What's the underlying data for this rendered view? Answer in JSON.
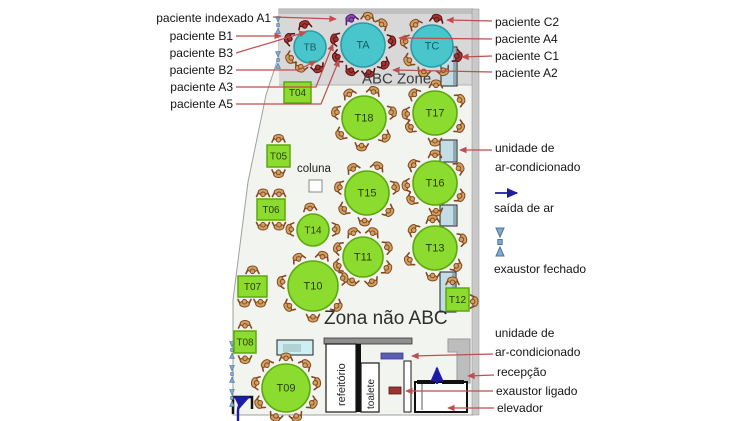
{
  "zones": {
    "abc": "ABC Zone",
    "non_abc": "Zona não ABC",
    "column": "coluna"
  },
  "rooms": {
    "cafeteria": "refeitório",
    "toilet": "toalete"
  },
  "colors": {
    "floor": "#f2f4ef",
    "zone": "#d8d8d8",
    "zone_top": "#bfbfbf",
    "wall": "#c9c9c9",
    "table_green": "#8bdc2f",
    "table_green_border": "#5ea80f",
    "table_cyan": "#49c6cc",
    "table_cyan_border": "#2e9aa4",
    "arrow_red": "#bf4e4e",
    "arrow_blue": "#1c1ca8",
    "exhaust_blue": "#82aacd",
    "exhaust_border": "#49739a",
    "person_tan": "#cda263",
    "person_tan_stroke": "#87471f",
    "person_red": "#a23432",
    "person_red_stroke": "#5c1414",
    "person_purple": "#8b4bad",
    "person_purple_stroke": "#502072",
    "ac_fill": "#c3dde6",
    "ac_edge": "#93a9b4",
    "purple_bar": "#5d5db2",
    "red_unit": "#9c3434",
    "sideboard": "#cdeef2",
    "reception": "#bdbdbd"
  },
  "left_labels": [
    {
      "text": "paciente indexado A1",
      "right": 271,
      "y": 18,
      "pts": [
        [
          273,
          17
        ],
        [
          336,
          19
        ]
      ]
    },
    {
      "text": "paciente B1",
      "right": 233,
      "y": 36,
      "pts": [
        [
          236,
          36
        ],
        [
          281,
          36
        ]
      ]
    },
    {
      "text": "paciente B3",
      "right": 233,
      "y": 53,
      "pts": [
        [
          236,
          53
        ],
        [
          306,
          32
        ]
      ]
    },
    {
      "text": "paciente B2",
      "right": 233,
      "y": 70,
      "pts": [
        [
          236,
          70
        ],
        [
          298,
          70
        ],
        [
          316,
          61
        ]
      ]
    },
    {
      "text": "paciente A3",
      "right": 233,
      "y": 87,
      "pts": [
        [
          236,
          87
        ],
        [
          316,
          87
        ],
        [
          333,
          44
        ]
      ]
    },
    {
      "text": "paciente A5",
      "right": 233,
      "y": 104,
      "pts": [
        [
          236,
          104
        ],
        [
          321,
          104
        ],
        [
          339,
          60
        ]
      ]
    }
  ],
  "right_labels": [
    {
      "text": "paciente C2",
      "left": 495,
      "y": 22,
      "pts": [
        [
          492,
          21
        ],
        [
          447,
          20
        ]
      ]
    },
    {
      "text": "paciente A4",
      "left": 495,
      "y": 39,
      "pts": [
        [
          492,
          39
        ],
        [
          399,
          38
        ]
      ]
    },
    {
      "text": "paciente C1",
      "left": 495,
      "y": 56,
      "pts": [
        [
          492,
          56
        ],
        [
          462,
          57
        ]
      ]
    },
    {
      "text": "paciente A2",
      "left": 495,
      "y": 73,
      "pts": [
        [
          492,
          72
        ],
        [
          393,
          70
        ]
      ]
    }
  ],
  "legend": {
    "ac_line1": {
      "text": "unidade de",
      "left": 495,
      "y": 148
    },
    "ac_line2": {
      "text": "ar-condicionado",
      "left": 495,
      "y": 167,
      "pts": [
        [
          492,
          150
        ],
        [
          460,
          150
        ]
      ]
    },
    "air_out": {
      "text": "saída de ar",
      "left": 494,
      "y": 208
    },
    "exhaust_closed": {
      "text": "exaustor fechado",
      "left": 494,
      "y": 269
    }
  },
  "bottom_labels": [
    {
      "text": "unidade de",
      "left": 495,
      "y": 333
    },
    {
      "text": "ar-condicionado",
      "left": 495,
      "y": 352,
      "pts": [
        [
          493,
          354
        ],
        [
          412,
          356
        ]
      ]
    },
    {
      "text": "recepção",
      "left": 497,
      "y": 372,
      "pts": [
        [
          494,
          375
        ],
        [
          468,
          376
        ]
      ]
    },
    {
      "text": "exaustor ligado",
      "left": 496,
      "y": 391,
      "pts": [
        [
          493,
          391
        ],
        [
          406,
          391
        ]
      ]
    },
    {
      "text": "elevador",
      "left": 497,
      "y": 408,
      "pts": [
        [
          494,
          408
        ],
        [
          448,
          408
        ]
      ]
    }
  ],
  "tables": [
    {
      "id": "TB",
      "label": "TB",
      "shape": "circle",
      "cx": 310,
      "cy": 47,
      "r": 16,
      "kind": "cyan",
      "seats": [
        {
          "a": 158,
          "c": "red"
        },
        {
          "a": 104,
          "c": "red"
        },
        {
          "a": -69,
          "c": "red"
        },
        {
          "a": 210,
          "c": "tan"
        },
        {
          "a": -115,
          "c": "tan"
        }
      ]
    },
    {
      "id": "TA",
      "label": "TA",
      "shape": "circle",
      "cx": 363,
      "cy": 45,
      "r": 22,
      "kind": "cyan",
      "seats": [
        {
          "a": 115,
          "c": "purple"
        },
        {
          "a": 168,
          "c": "red"
        },
        {
          "a": 205,
          "c": "red"
        },
        {
          "a": 245,
          "c": "red"
        },
        {
          "a": 282,
          "c": "red"
        },
        {
          "a": 318,
          "c": "red"
        },
        {
          "a": 8,
          "c": "red"
        },
        {
          "a": 48,
          "c": "tan"
        },
        {
          "a": 80,
          "c": "tan"
        }
      ]
    },
    {
      "id": "TC",
      "label": "TC",
      "shape": "circle",
      "cx": 432,
      "cy": 46,
      "r": 21,
      "kind": "cyan",
      "seats": [
        {
          "a": 80,
          "c": "red"
        },
        {
          "a": -22,
          "c": "red"
        },
        {
          "a": 128
        },
        {
          "a": 170
        },
        {
          "a": 212
        },
        {
          "a": 252
        },
        {
          "a": 295
        }
      ]
    },
    {
      "id": "T18",
      "label": "T18",
      "shape": "circle",
      "cx": 364,
      "cy": 118,
      "r": 22,
      "kind": "green",
      "seats": [
        {
          "a": 122
        },
        {
          "a": 70
        },
        {
          "a": 12
        },
        {
          "a": -42
        },
        {
          "a": -95
        },
        {
          "a": -145
        },
        {
          "a": 168
        }
      ]
    },
    {
      "id": "T17",
      "label": "T17",
      "shape": "circle",
      "cx": 435,
      "cy": 113,
      "r": 22,
      "kind": "green",
      "seats": [
        {
          "a": 138
        },
        {
          "a": 88
        },
        {
          "a": 28
        },
        {
          "a": -30
        },
        {
          "a": -90
        },
        {
          "a": -150
        },
        {
          "a": 182
        }
      ]
    },
    {
      "id": "T15",
      "label": "T15",
      "shape": "circle",
      "cx": 367,
      "cy": 193,
      "r": 22,
      "kind": "green",
      "seats": [
        {
          "a": 120
        },
        {
          "a": 68
        },
        {
          "a": 12
        },
        {
          "a": -40
        },
        {
          "a": -95
        },
        {
          "a": -145
        },
        {
          "a": 168
        }
      ]
    },
    {
      "id": "T16",
      "label": "T16",
      "shape": "circle",
      "cx": 435,
      "cy": 183,
      "r": 22,
      "kind": "green",
      "seats": [
        {
          "a": 140
        },
        {
          "a": 90
        },
        {
          "a": 32
        },
        {
          "a": -28
        },
        {
          "a": -88
        },
        {
          "a": -145
        },
        {
          "a": 185
        }
      ]
    },
    {
      "id": "T14",
      "label": "T14",
      "shape": "circle",
      "cx": 313,
      "cy": 230,
      "r": 16,
      "kind": "green",
      "seats": [
        {
          "a": 98
        },
        {
          "a": 178
        },
        {
          "a": 2
        }
      ]
    },
    {
      "id": "T11",
      "label": "T11",
      "shape": "circle",
      "cx": 363,
      "cy": 257,
      "r": 20,
      "kind": "green",
      "seats": [
        {
          "a": 112
        },
        {
          "a": 68
        },
        {
          "a": 22
        },
        {
          "a": -25
        },
        {
          "a": -70
        },
        {
          "a": -115
        },
        {
          "a": -160
        },
        {
          "a": 160
        }
      ]
    },
    {
      "id": "T13",
      "label": "T13",
      "shape": "circle",
      "cx": 435,
      "cy": 248,
      "r": 22,
      "kind": "green",
      "seats": [
        {
          "a": 140
        },
        {
          "a": 95
        },
        {
          "a": 18
        },
        {
          "a": -40
        },
        {
          "a": -95
        },
        {
          "a": -155
        }
      ]
    },
    {
      "id": "T10",
      "label": "T10",
      "shape": "circle",
      "cx": 313,
      "cy": 286,
      "r": 25,
      "kind": "green",
      "seats": [
        {
          "a": 118
        },
        {
          "a": 72
        },
        {
          "a": 15
        },
        {
          "a": -40
        },
        {
          "a": -90
        },
        {
          "a": -140
        },
        {
          "a": 172
        }
      ]
    },
    {
      "id": "T09",
      "label": "T09",
      "shape": "circle",
      "cx": 286,
      "cy": 388,
      "r": 24,
      "kind": "green",
      "seats": [
        {
          "a": 90
        },
        {
          "a": 50
        },
        {
          "a": 10
        },
        {
          "a": -30
        },
        {
          "a": -70
        },
        {
          "a": -110
        },
        {
          "a": -150
        },
        {
          "a": 170
        },
        {
          "a": 130
        }
      ]
    },
    {
      "id": "T04",
      "label": "T04",
      "shape": "rect",
      "x": 284,
      "y": 82,
      "w": 27,
      "h": 21,
      "kind": "green",
      "seats": []
    },
    {
      "id": "T05",
      "label": "T05",
      "shape": "rect",
      "x": 267,
      "y": 145,
      "w": 23,
      "h": 22,
      "kind": "green",
      "seats": [
        {
          "dx": 0,
          "dy": -18,
          "rot": 180
        },
        {
          "dx": 0,
          "dy": 18,
          "rot": 0
        }
      ]
    },
    {
      "id": "T06",
      "label": "T06",
      "shape": "rect",
      "x": 257,
      "y": 199,
      "w": 28,
      "h": 21,
      "kind": "green",
      "seats": [
        {
          "dx": -8,
          "dy": -17,
          "rot": 180
        },
        {
          "dx": 8,
          "dy": -17,
          "rot": 180
        },
        {
          "dx": -8,
          "dy": 17,
          "rot": 0
        },
        {
          "dx": 8,
          "dy": 17,
          "rot": 0
        }
      ]
    },
    {
      "id": "T07",
      "label": "T07",
      "shape": "rect",
      "x": 238,
      "y": 276,
      "w": 29,
      "h": 21,
      "kind": "green",
      "seats": [
        {
          "dx": 0,
          "dy": -17,
          "rot": 180
        },
        {
          "dx": -8,
          "dy": 17,
          "rot": 0
        },
        {
          "dx": 8,
          "dy": 17,
          "rot": 0
        }
      ]
    },
    {
      "id": "T08",
      "label": "T08",
      "shape": "rect",
      "x": 234,
      "y": 331,
      "w": 22,
      "h": 22,
      "kind": "green",
      "seats": [
        {
          "dx": 0,
          "dy": -18,
          "rot": 180
        },
        {
          "dx": 0,
          "dy": 18,
          "rot": 0
        }
      ]
    },
    {
      "id": "T12",
      "label": "T12",
      "shape": "rect",
      "x": 446,
      "y": 288,
      "w": 23,
      "h": 23,
      "kind": "green",
      "seats": [
        {
          "dx": -5,
          "dy": -19,
          "rot": 180
        },
        {
          "dx": 17,
          "dy": 2,
          "rot": -90
        }
      ]
    }
  ],
  "ac_units": [
    {
      "x": 441,
      "y": 47,
      "w": 16,
      "h": 39
    },
    {
      "x": 440,
      "y": 140,
      "w": 17,
      "h": 22
    },
    {
      "x": 440,
      "y": 205,
      "w": 17,
      "h": 21
    },
    {
      "x": 440,
      "y": 272,
      "w": 16,
      "h": 40
    }
  ],
  "wall_exhausts": [
    {
      "x": 278,
      "y": 25
    },
    {
      "x": 278,
      "y": 60
    },
    {
      "x": 232,
      "y": 350
    },
    {
      "x": 232,
      "y": 374
    },
    {
      "x": 232,
      "y": 398
    }
  ],
  "fixtures": {
    "purple_ac_bar": {
      "x": 381,
      "y": 353,
      "w": 22,
      "h": 6
    },
    "red_exhaust_unit": {
      "x": 389,
      "y": 387,
      "w": 12,
      "h": 7
    },
    "sideboard": {
      "x": 277,
      "y": 340,
      "w": 36,
      "h": 15
    },
    "column": {
      "x": 309,
      "y": 180,
      "w": 13,
      "h": 12
    },
    "elevator": {
      "x": 415,
      "y": 382,
      "w": 52,
      "h": 30
    }
  }
}
